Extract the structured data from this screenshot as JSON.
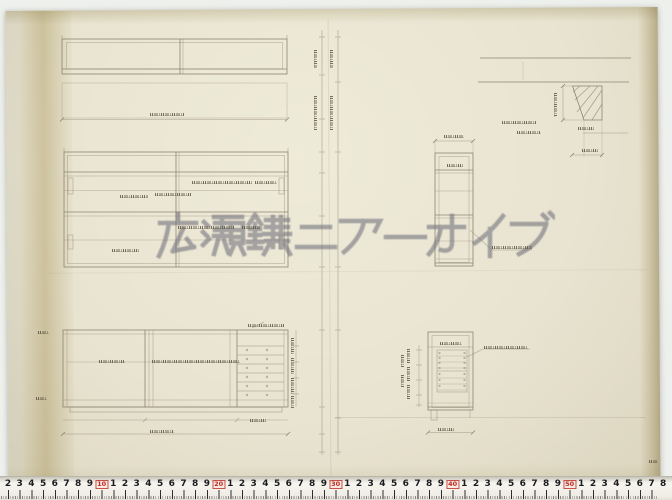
{
  "watermark": {
    "text": "広瀬鎌二アーカイブ",
    "color": "#70707a"
  },
  "ruler": {
    "first_number": 2,
    "last_number": 58,
    "decade_values": [
      10,
      20,
      30,
      40,
      50
    ],
    "number_color": "#1c1c20",
    "decade_color": "#b92b20",
    "unit_px": 11.7,
    "origin_px": -15.4
  },
  "paper": {
    "background_color": "#e9e4d1",
    "scan_background_color": "#eef0ed",
    "pencil_color": "#8d8470"
  },
  "drawing_views": {
    "top_left": "plan-view-of-cabinet",
    "middle_left": "front-elevation-upper-cabinet",
    "bottom_left": "front-elevation-lower-cabinet-with-drawers",
    "top_right": "hatched-section-detail",
    "middle_right": "vertical-section-tall",
    "bottom_right": "vertical-section-drawer-unit"
  },
  "pencil_notes": [
    {
      "x": 150,
      "y": 113,
      "len": 34
    },
    {
      "x": 192,
      "y": 181,
      "len": 60
    },
    {
      "x": 255,
      "y": 181,
      "len": 22
    },
    {
      "x": 120,
      "y": 195,
      "len": 28
    },
    {
      "x": 155,
      "y": 193,
      "len": 36
    },
    {
      "x": 178,
      "y": 226,
      "len": 56
    },
    {
      "x": 242,
      "y": 226,
      "len": 18
    },
    {
      "x": 112,
      "y": 249,
      "len": 27
    },
    {
      "x": 99,
      "y": 360,
      "len": 26
    },
    {
      "x": 152,
      "y": 360,
      "len": 88
    },
    {
      "x": 248,
      "y": 324,
      "len": 36
    },
    {
      "x": 150,
      "y": 430,
      "len": 24
    },
    {
      "x": 250,
      "y": 419,
      "len": 16
    },
    {
      "x": 38,
      "y": 331,
      "len": 11
    },
    {
      "x": 36,
      "y": 397,
      "len": 11
    },
    {
      "x": 294,
      "y": 338,
      "len": 16,
      "v": 1
    },
    {
      "x": 294,
      "y": 358,
      "len": 16,
      "v": 1
    },
    {
      "x": 294,
      "y": 378,
      "len": 16,
      "v": 1
    },
    {
      "x": 294,
      "y": 396,
      "len": 12,
      "v": 1
    },
    {
      "x": 317,
      "y": 96,
      "len": 34,
      "v": 1
    },
    {
      "x": 333,
      "y": 96,
      "len": 34,
      "v": 1
    },
    {
      "x": 317,
      "y": 50,
      "len": 18,
      "v": 1
    },
    {
      "x": 333,
      "y": 50,
      "len": 18,
      "v": 1
    },
    {
      "x": 557,
      "y": 93,
      "len": 24,
      "v": 1
    },
    {
      "x": 502,
      "y": 121,
      "len": 34
    },
    {
      "x": 578,
      "y": 127,
      "len": 16
    },
    {
      "x": 582,
      "y": 149,
      "len": 16
    },
    {
      "x": 444,
      "y": 135,
      "len": 20
    },
    {
      "x": 447,
      "y": 164,
      "len": 16
    },
    {
      "x": 492,
      "y": 246,
      "len": 40
    },
    {
      "x": 517,
      "y": 131,
      "len": 24
    },
    {
      "x": 440,
      "y": 342,
      "len": 22
    },
    {
      "x": 484,
      "y": 346,
      "len": 44
    },
    {
      "x": 438,
      "y": 428,
      "len": 16
    },
    {
      "x": 410,
      "y": 349,
      "len": 14,
      "v": 1
    },
    {
      "x": 410,
      "y": 367,
      "len": 14,
      "v": 1
    },
    {
      "x": 410,
      "y": 385,
      "len": 14,
      "v": 1
    },
    {
      "x": 404,
      "y": 355,
      "len": 12,
      "v": 1
    },
    {
      "x": 404,
      "y": 375,
      "len": 12,
      "v": 1
    },
    {
      "x": 649,
      "y": 460,
      "len": 9
    }
  ]
}
